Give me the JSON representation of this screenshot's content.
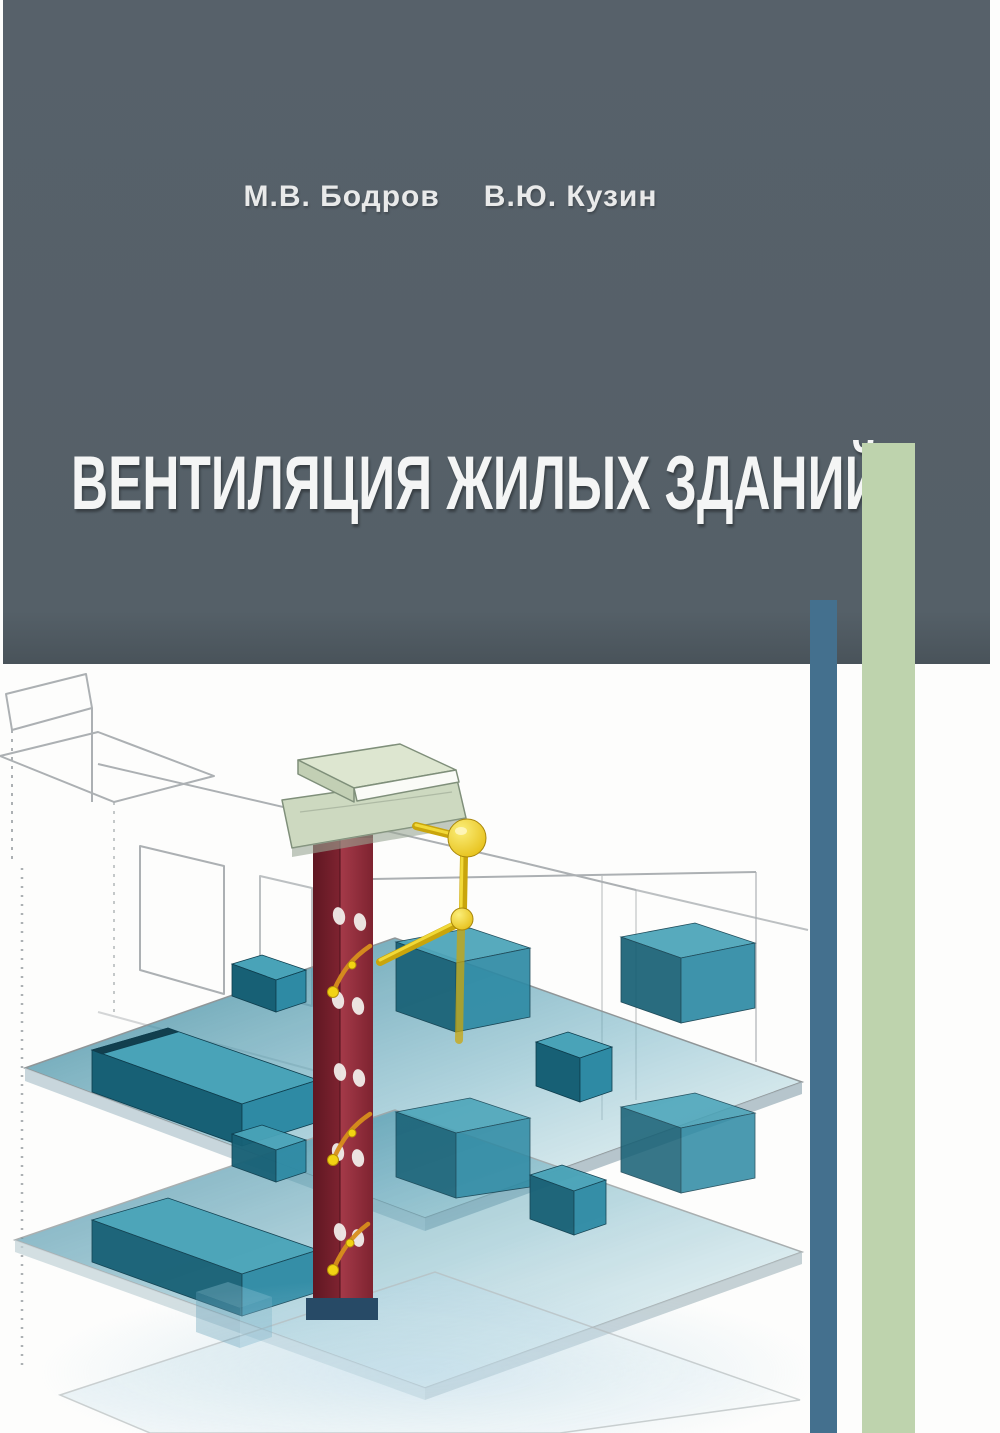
{
  "cover": {
    "authors": [
      "М.В. Бодров",
      "В.Ю. Кузин"
    ],
    "title": "ВЕНТИЛЯЦИЯ ЖИЛЫХ ЗДАНИЙ",
    "illustration_description": "Isometric cutaway of a multi-storey residential building: vertical dark-red exhaust ventilation shaft with a pale-green roof cowl, yellow duct connections with spherical joints, translucent teal floor slabs with equipment boxes, pencil-sketch walls, light-blue ground reflection",
    "colors": {
      "header_bg": "#57616a",
      "green_stripe": "#bed3ad",
      "blue_stripe": "#44708e",
      "title": "#f4f5f5",
      "authors": "#e9eaea",
      "shaft_red": "#8c2433",
      "shaft_dark": "#5f1722",
      "pipe_yellow": "#eec911",
      "slab_teal": "#2a7b94",
      "box_teal_dark": "#176075",
      "box_teal_mid": "#2e8aa4",
      "box_teal_top": "#49a3b8",
      "cowl_green": "#cdd9c0",
      "sketch_gray": "#a3a8ab",
      "reflection_blue": "#bcd9e8",
      "background": "#ffffff"
    }
  }
}
